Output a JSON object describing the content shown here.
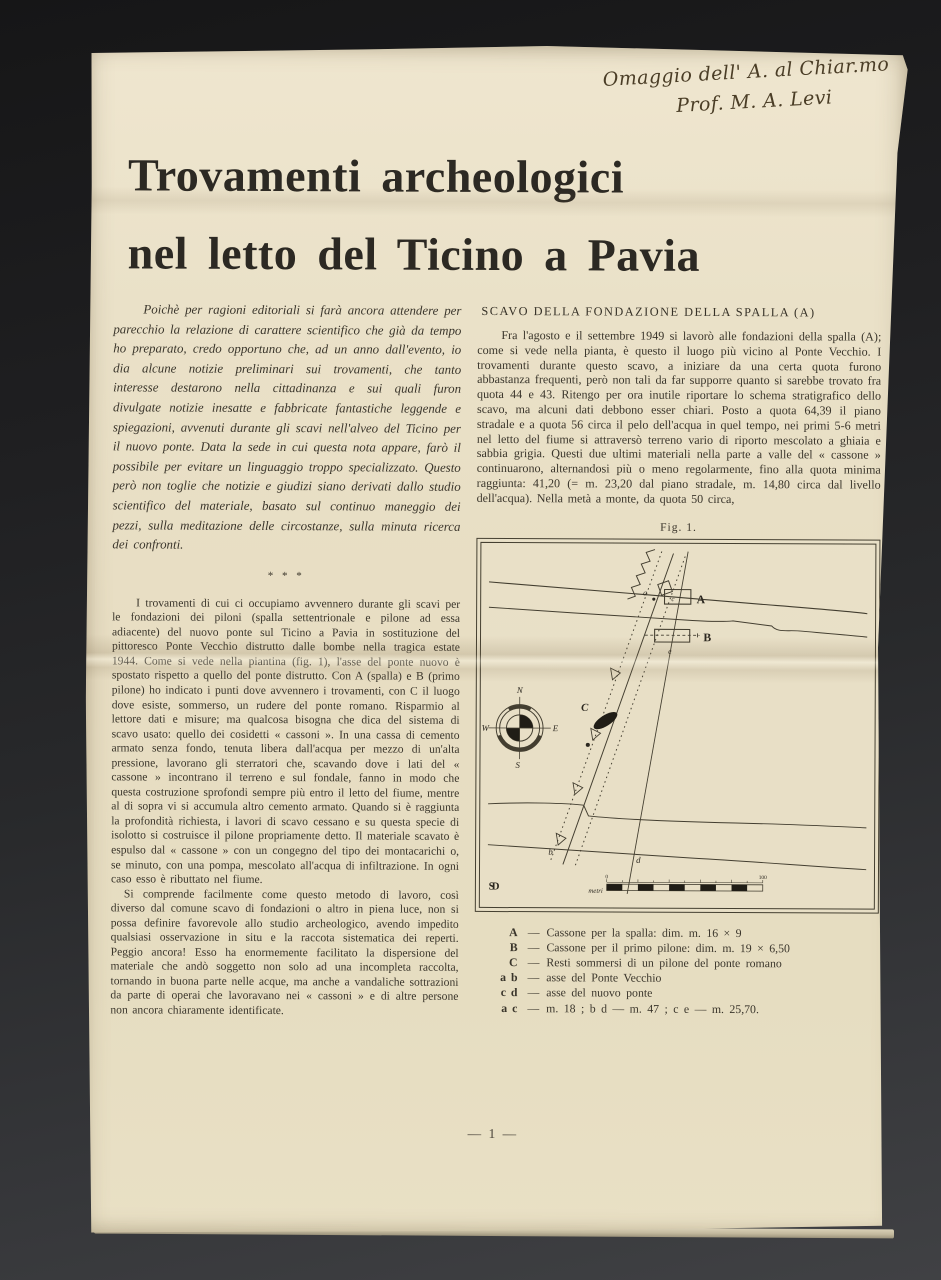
{
  "handwriting": {
    "line1": "Omaggio dell' A. al Chiar.mo",
    "line2": "Prof. M. A. Levi"
  },
  "title": {
    "line1": "Trovamenti archeologici",
    "line2": "nel letto del Ticino a Pavia"
  },
  "left_column": {
    "intro": "Poichè per ragioni editoriali si farà ancora attendere per parecchio la relazione di carattere scientifico che già da tempo ho preparato, credo opportuno che, ad un anno dall'evento, io dia alcune notizie preliminari sui trovamenti, che tanto interesse destarono nella cittadinanza e sui quali furon divulgate notizie inesatte e fabbricate fantastiche leggende e spiegazioni, avvenuti durante gli scavi nell'alveo del Ticino per il nuovo ponte. Data la sede in cui questa nota appare, farò il possibile per evitare un linguaggio troppo specializzato. Questo però non toglie che notizie e giudizi siano derivati dallo studio scientifico del materiale, basato sul continuo maneggio dei pezzi, sulla meditazione delle circostanze, sulla minuta ricerca dei confronti.",
    "separator": "* * *",
    "para1": "I trovamenti di cui ci occupiamo avvennero durante gli scavi per le fondazioni dei piloni (spalla settentrionale e pilone ad essa adiacente) del nuovo ponte sul Ticino a Pavia in sostituzione del pittoresco Ponte Vecchio distrutto dalle bombe nella tragica estate 1944. Come si vede nella piantina (fig. 1), l'asse del ponte nuovo è spostato rispetto a quello del ponte distrutto. Con A (spalla) e B (primo pilone) ho indicato i punti dove avvennero i trovamenti, con C il luogo dove esiste, sommerso, un rudere del ponte romano. Risparmio al lettore dati e misure; ma qualcosa bisogna che dica del sistema di scavo usato: quello dei cosidetti « cassoni ». In una cassa di cemento armato senza fondo, tenuta libera dall'acqua per mezzo di un'alta pressione, lavorano gli sterratori che, scavando dove i lati del « cassone » incontrano il terreno e sul fondale, fanno in modo che questa costruzione sprofondi sempre più entro il letto del fiume, mentre al di sopra vi si accumula altro cemento armato. Quando si è raggiunta la profondità richiesta, i lavori di scavo cessano e su questa specie di isolotto si costruisce il pilone propriamente detto. Il materiale scavato è espulso dal « cassone » con un congegno del tipo dei montacarichi o, se minuto, con una pompa, mescolato all'acqua di infiltrazione. In ogni caso esso è ributtato nel fiume.",
    "para2": "Si comprende facilmente come questo metodo di lavoro, così diverso dal comune scavo di fondazioni o altro in piena luce, non si possa definire favorevole allo studio archeologico, avendo impedito qualsiasi osservazione in situ e la raccota sistematica dei reperti. Peggio ancora! Esso ha enormemente facilitato la dispersione del materiale che andò soggetto non solo ad una incompleta raccolta, tornando in buona parte nelle acque, ma anche a vandaliche sottrazioni da parte di operai che lavoravano nei « cassoni » e di altre persone non ancora chiaramente identificate."
  },
  "right_column": {
    "heading": "SCAVO DELLA FONDAZIONE DELLA SPALLA (A)",
    "para1": "Fra l'agosto e il settembre 1949 si lavorò alle fondazioni della spalla (A); come si vede nella pianta, è questo il luogo più vicino al Ponte Vecchio. I trovamenti durante questo scavo, a iniziare da una certa quota furono abbastanza frequenti, però non tali da far supporre quanto si sarebbe trovato fra quota 44 e 43. Ritengo per ora inutile riportare lo schema stratigrafico dello scavo, ma alcuni dati debbono esser chiari. Posto a quota 64,39 il piano stradale e a quota 56 circa il pelo dell'acqua in quel tempo, nei primi 5-6 metri nel letto del fiume si attraversò terreno vario di riporto mescolato a ghiaia e sabbia grigia. Questi due ultimi materiali nella parte a valle del « cassone » continuarono, alternandosi più o meno regolarmente, fino alla quota minima raggiunta: 41,20 (= m. 23,20 dal piano stradale, m. 14,80 circa dal livello dell'acqua). Nella metà a monte, da quota 50 circa,"
  },
  "figure": {
    "caption": "Fig. 1.",
    "labels": {
      "A": "A",
      "B": "B",
      "C": "C",
      "a": "a",
      "b": "b",
      "c": "c",
      "d": "d",
      "e": "e",
      "north": "N",
      "east": "E",
      "south": "S",
      "west": "W",
      "scale_unit": "metri",
      "scale_start": "0",
      "scale_end": "100",
      "monogram": "SD"
    },
    "legend_dash": "—",
    "legend": [
      {
        "key": "A",
        "text": "Cassone per la spalla: dim. m. 16 × 9"
      },
      {
        "key": "B",
        "text": "Cassone per il primo pilone: dim. m. 19 × 6,50"
      },
      {
        "key": "C",
        "text": "Resti sommersi di un pilone del ponte romano"
      },
      {
        "key": "a b",
        "text": "asse del Ponte Vecchio"
      },
      {
        "key": "c d",
        "text": "asse del nuovo ponte"
      },
      {
        "key": "a c",
        "text": "m. 18 ;  b d — m. 47 ;  c e — m. 25,70."
      }
    ]
  },
  "footer": {
    "page_number": "— 1 —"
  }
}
